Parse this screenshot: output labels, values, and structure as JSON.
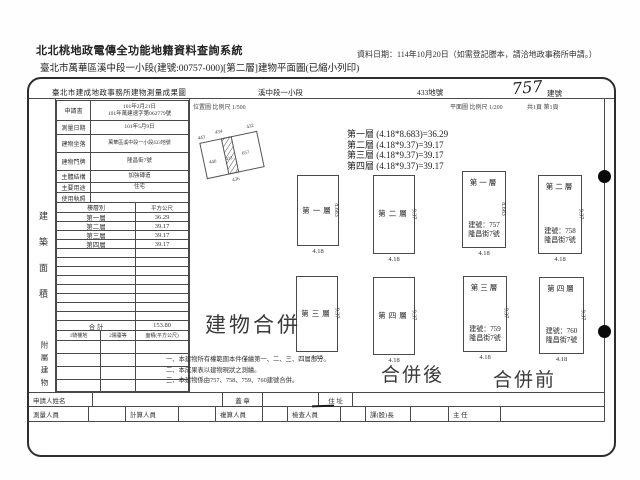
{
  "topbar": {
    "system_title": "北北桃地政電傳全功能地籍資料查詢系統",
    "data_date": "資料日期：114年10月20日（如需登記謄本，請洽地政事務所申請。）",
    "doc_subtitle": "臺北市萬華區溪中段一小段(建號:00757-000)[第二層]建物平面圖(已縮小列印)"
  },
  "doc": {
    "office_title": "臺北市建成地政事務所建物測量成果圖",
    "section_name": "溪中段一小段",
    "parcel_no": "433地號",
    "building_no": "757",
    "building_no_label": "建號",
    "location_scale": "位置圖 比例尺 1/500",
    "plan_scale": "平面圖 比例尺 1/200",
    "page_info": "共1頁 第1頁",
    "info_rows": [
      {
        "label": "申請書",
        "value": "101年2月21日",
        "value2": "101年萬建速字第062779號"
      },
      {
        "label": "測量日期",
        "value": "101年5月9日"
      },
      {
        "label": "建物坐落",
        "value": "萬華區溪中段一小段433地號"
      },
      {
        "label": "建物門牌",
        "value": "隆昌街7號"
      },
      {
        "label": "主體結構",
        "value": "加強磚造"
      },
      {
        "label": "主要用途",
        "value": "住宅"
      },
      {
        "label": "使用執照",
        "value": ""
      }
    ],
    "floor_table": {
      "col_floor": "樓層別",
      "col_area": "平方公尺",
      "rows": [
        {
          "floor": "第一層",
          "area": "36.29"
        },
        {
          "floor": "第二層",
          "area": "39.17"
        },
        {
          "floor": "第三層",
          "area": "39.17"
        },
        {
          "floor": "第四層",
          "area": "39.17"
        }
      ],
      "total_label": "合 計",
      "total_value": "153.80",
      "annex_cols": [
        "1騎樓地",
        "2陽臺等",
        "面積(平方公尺)"
      ]
    },
    "vertical_label_main": "建築面積",
    "vertical_label_annex": "附屬建物",
    "sketch_labels": [
      "443",
      "434",
      "432",
      "440",
      "433",
      "657",
      "436"
    ],
    "calc_lines": [
      "第一層 (4.18*8.683)=36.29",
      "第二層 (4.18*9.37)=39.17",
      "第三層 (4.18*9.37)=39.17",
      "第四層 (4.18*9.37)=39.17"
    ],
    "plans_after": [
      {
        "floor": "第一層",
        "side": "8.683",
        "width": "4.18"
      },
      {
        "floor": "第二層",
        "side": "9.37",
        "width": "4.18"
      },
      {
        "floor": "第三層",
        "side": "9.37",
        "width": "4.18"
      },
      {
        "floor": "第四層",
        "side": "9.37",
        "width": "4.18"
      }
    ],
    "plans_before": [
      {
        "floor": "第一層",
        "bno": "建號：757",
        "addr": "隆昌街7號",
        "side": "8.683",
        "width": "4.18"
      },
      {
        "floor": "第二層",
        "bno": "建號：758",
        "addr": "隆昌街7號",
        "side": "9.37",
        "width": "4.18"
      },
      {
        "floor": "第三層",
        "bno": "建號：759",
        "addr": "隆昌街7號",
        "side": "9.37",
        "width": "4.18"
      },
      {
        "floor": "第四層",
        "bno": "建號：760",
        "addr": "隆昌街7號",
        "side": "9.37",
        "width": "4.18"
      }
    ],
    "merge_title": "建物合併",
    "after_label": "合併後",
    "before_label": "合併前",
    "notes": [
      "一、本建物所有權範圍本件僅繪第一、二、三、四層部分。",
      "二、本成果表以建物現狀之測繪。",
      "三、本建物係由757、758、759、760建號合併。"
    ],
    "footer": {
      "applicant_label": "申請人姓名",
      "seal_label": "蓋 章",
      "address_label": "住 址",
      "staff": [
        "測量人員",
        "計算人員",
        "複算人員",
        "檢查人員",
        "課(股)長",
        "主 任"
      ]
    }
  }
}
